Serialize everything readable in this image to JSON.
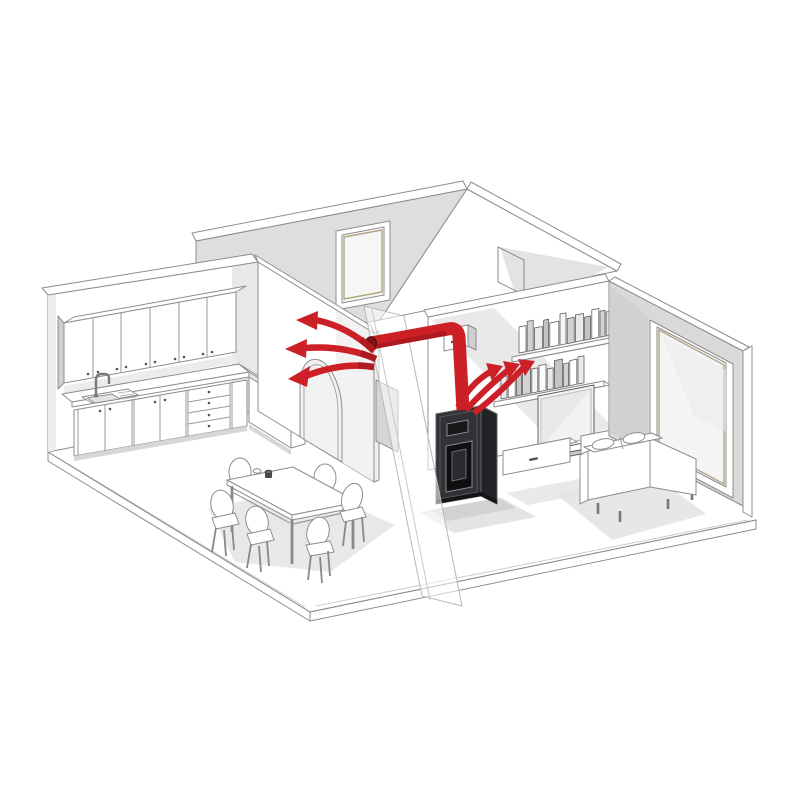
{
  "figure": {
    "type": "isometric-cutaway-illustration",
    "description": "Isometric cutaway drawing of an apartment: a pellet stove in the living room sends warm air through a concealed wall duct (red) with three arrows blowing into the kitchen-dining room and three arrows rising from the stove top into the living room",
    "background": "#ffffff"
  },
  "colors": {
    "background": "#ffffff",
    "line": "#8d8d8d",
    "line_dark": "#606060",
    "wall_white": "#ffffff",
    "wall_gray": "#dedede",
    "wall_gray_dark": "#cfcfcf",
    "shadow": "#e4e4e4",
    "accent_red": "#cd2026",
    "accent_red_dark": "#8f1318",
    "stove_front": "#323236",
    "stove_side": "#232327",
    "stove_top": "#6b6b70",
    "glass_tan": "#b3a584"
  },
  "rooms": {
    "kitchen": {
      "elements": [
        "wall-cabinet-row-6-doors",
        "countertop-L-shaped",
        "double-sink",
        "gooseneck-faucet",
        "base-cabinet-doors",
        "drawer-stack-4",
        "corner-unit"
      ]
    },
    "dining": {
      "elements": [
        "rectangular-table",
        "chairs-x6",
        "cups-x2"
      ]
    },
    "hallway": {
      "elements": [
        "exterior-window",
        "arched-doorway",
        "section-cut-glass-plane",
        "door-outline"
      ]
    },
    "living_room": {
      "elements": [
        "upper-book-shelf",
        "lower-book-shelf",
        "flat-screen-tv",
        "tv-cabinet-left",
        "tv-cabinet-right",
        "two-seat-sofa",
        "full-height-window"
      ]
    }
  },
  "stove": {
    "type": "pellet-stove",
    "parts": [
      "top-vent-grille",
      "control-display",
      "fire-door-glass",
      "plinth"
    ]
  },
  "airflow": {
    "duct_route": "riser-from-stove-top, 90-degree-bend, horizontal-run-through-partition-wall, kitchen-outlet",
    "arrows_into_kitchen": 3,
    "arrows_into_living_room": 3,
    "vent_box": "wall-plenum-box"
  },
  "books": {
    "palette": [
      "#ffffff",
      "#e9e9e9",
      "#d2d2d2",
      "#f5f5f5",
      "#c4c4c4"
    ],
    "shelves": [
      {
        "name": "upper-shelf-books",
        "x0": 519,
        "y0": 353,
        "slope": -0.195,
        "gap": 1.2,
        "widths": [
          7,
          6,
          8,
          5,
          9,
          6,
          7,
          8,
          6,
          7,
          5,
          8,
          7
        ],
        "heights": [
          26,
          30,
          22,
          28,
          24,
          31,
          25,
          27,
          23,
          29,
          26,
          24,
          28
        ],
        "fills": [
          0,
          2,
          1,
          4,
          0,
          3,
          2,
          1,
          4,
          0,
          2,
          1,
          3
        ]
      },
      {
        "name": "lower-shelf-books",
        "x0": 501,
        "y0": 399,
        "slope": -0.195,
        "gap": 1.2,
        "widths": [
          6,
          7,
          5,
          8,
          6,
          7,
          6,
          8,
          5,
          7,
          6
        ],
        "heights": [
          22,
          27,
          20,
          29,
          24,
          26,
          21,
          28,
          23,
          25,
          27
        ],
        "fills": [
          1,
          0,
          4,
          2,
          3,
          0,
          1,
          4,
          2,
          0,
          1
        ]
      }
    ]
  }
}
